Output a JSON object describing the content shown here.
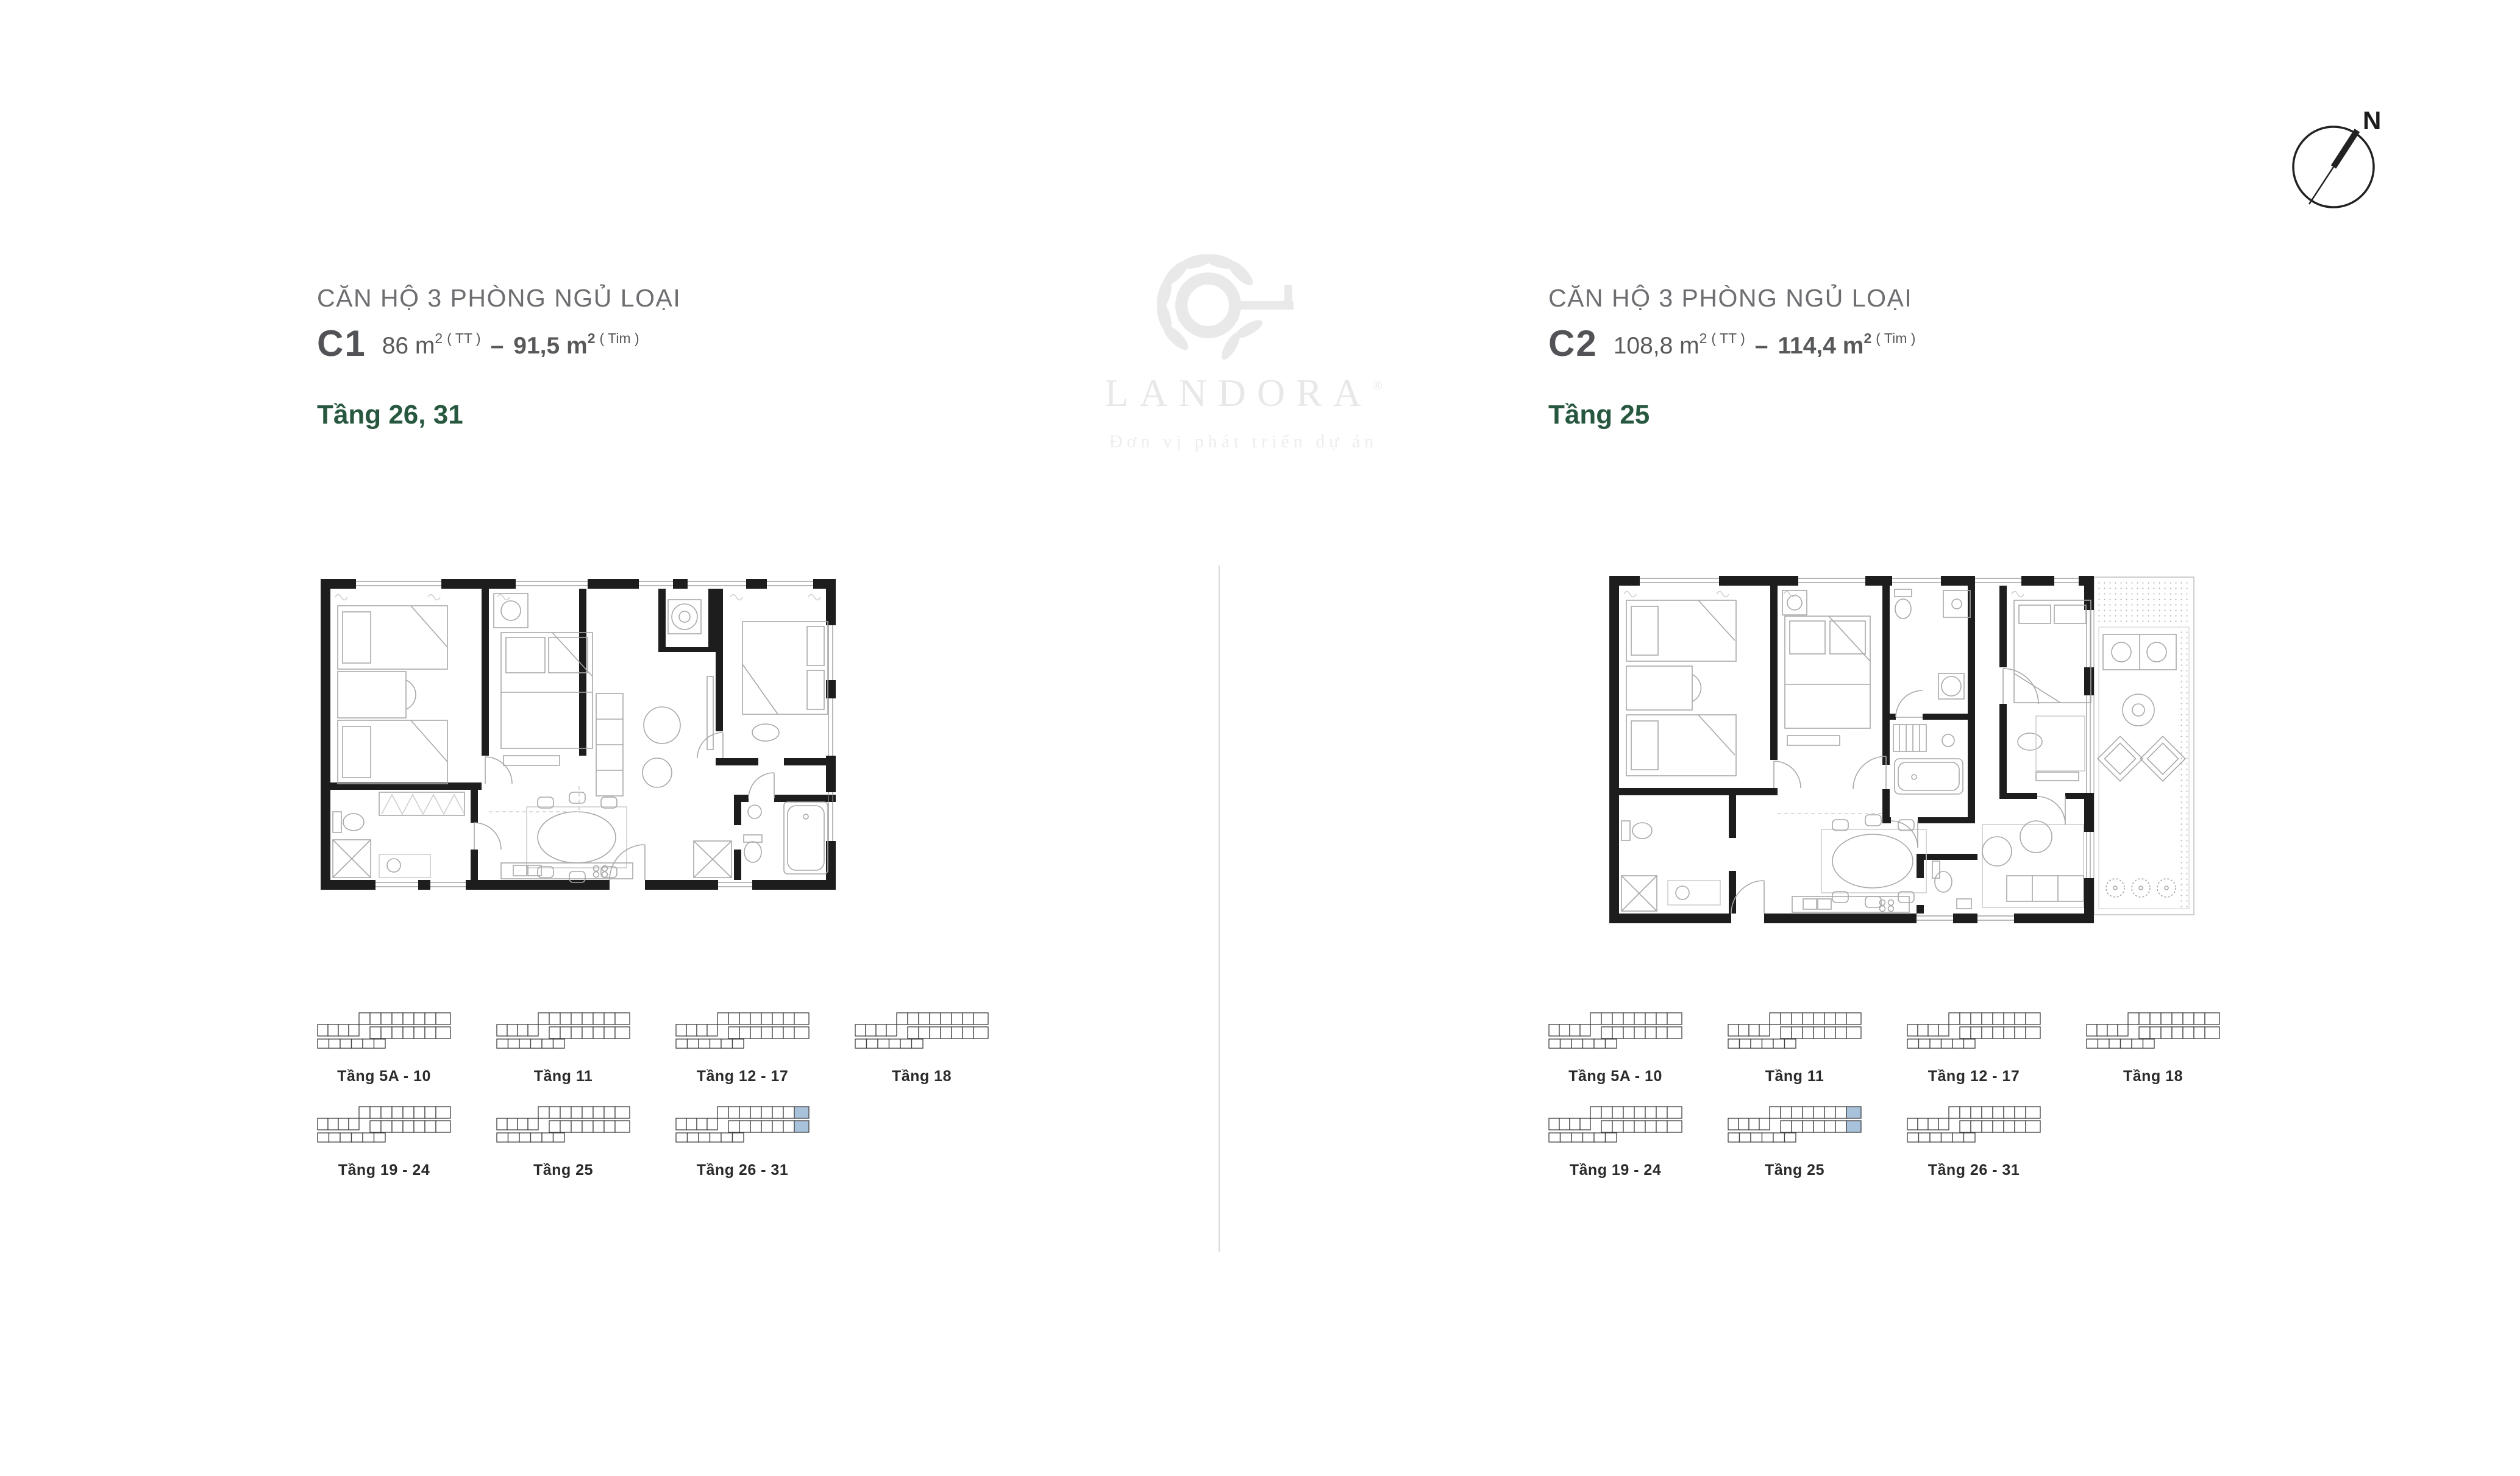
{
  "compass": {
    "north_label": "N"
  },
  "watermark": {
    "brand": "LANDORA",
    "registered": "®",
    "tagline": "Đơn vị phát triển dự án"
  },
  "colors": {
    "accent_green": "#27583f",
    "heading_gray": "#6d6e71",
    "code_gray": "#525357",
    "area_gray": "#58595b",
    "label_dark": "#2b2b2b",
    "wall_black": "#1d1d1d",
    "plan_line_gray": "#a8a8a8",
    "highlight_blue": "#a9c2dc",
    "watermark_gray": "#e9e9e9",
    "divider_gray": "#dadada"
  },
  "floor_diagram_labels": [
    "Tầng 5A - 10",
    "Tầng 11",
    "Tầng 12 - 17",
    "Tầng 18",
    "Tầng 19 - 24",
    "Tầng 25",
    "Tầng 26 - 31"
  ],
  "units": [
    {
      "code": "C1",
      "title": "CĂN HỘ 3 PHÒNG NGỦ LOẠI",
      "area_primary": "86 m",
      "area_primary_sup": "2",
      "area_primary_note": "( TT )",
      "separator": "–",
      "area_secondary": "91,5 m",
      "area_secondary_sup": "2",
      "area_secondary_note": "( Tim )",
      "floors": "Tầng 26, 31",
      "highlighted_floor_label": "Tầng 26 - 31",
      "highlight_floor_index": 6
    },
    {
      "code": "C2",
      "title": "CĂN HỘ 3 PHÒNG NGỦ LOẠI",
      "area_primary": "108,8 m",
      "area_primary_sup": "2",
      "area_primary_note": "( TT )",
      "separator": "–",
      "area_secondary": "114,4 m",
      "area_secondary_sup": "2",
      "area_secondary_note": "( Tim )",
      "floors": "Tầng 25",
      "highlighted_floor_label": "Tầng 25",
      "highlight_floor_index": 5
    }
  ]
}
